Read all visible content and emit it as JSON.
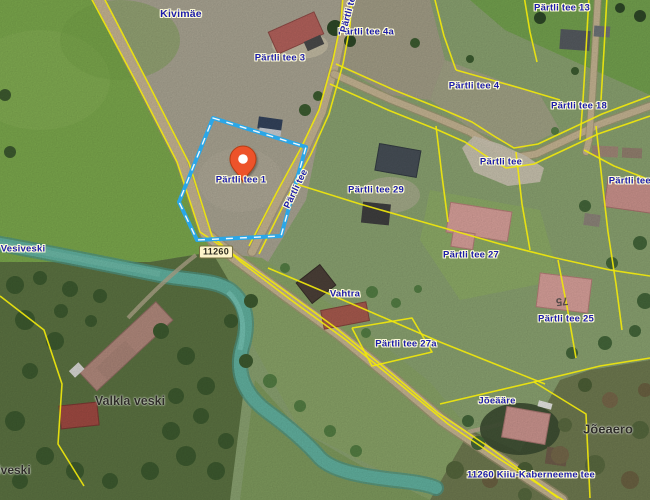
{
  "theme": {
    "parcel_highlight": "#2aa7e8",
    "pin_color": "#ed5329",
    "cadastral_line": "#f0e70c",
    "address_label_color": "#1c1caa",
    "place_label_color": "#2e2d28",
    "road_badge_bg": "#fdf3c9"
  },
  "labels": {
    "kivimae": "Kivimäe",
    "vesiveski": "Vesiveski",
    "valkla_veski": "Valkla veski",
    "joeaero": "Jõeaero",
    "iveski_partial": "iveski",
    "vahtra": "Vahtra",
    "joeaare": "Jõeääre",
    "partli_tee_1": "Pärtli tee 1",
    "partli_tee_3": "Pärtli tee 3",
    "partli_tee_4a": "Pärtli tee 4a",
    "partli_tee_4": "Pärtli tee 4",
    "partli_tee_13": "Pärtli tee 13",
    "partli_tee_18": "Pärtli tee 18",
    "partli_tee_29": "Pärtli tee 29",
    "partli_tee_27": "Pärtli tee 27",
    "partli_tee_27a": "Pärtli tee 27a",
    "partli_tee_25": "Pärtli tee 25",
    "partli_tee_2": "Pärtli tee 2",
    "partli_tee_road": "Pärtli tee",
    "kiiu_kaberneeme_tee": "11260 Kiiu-Kaberneeme tee",
    "road_number_badge": "11260",
    "roof_marking_75": "75"
  }
}
